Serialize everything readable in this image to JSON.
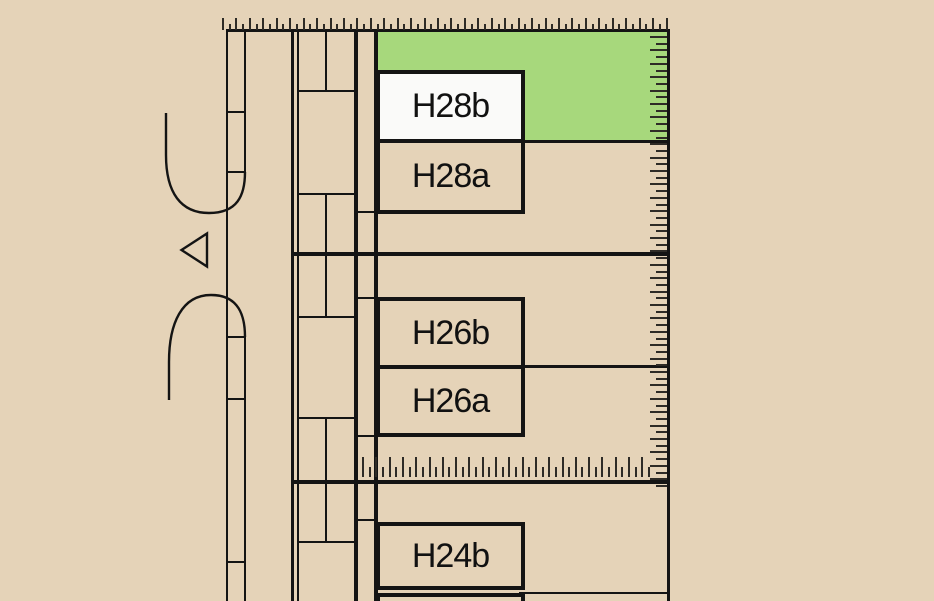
{
  "labels": {
    "h28b": "H28b",
    "h28a": "H28a",
    "h26b": "H26b",
    "h26a": "H26a",
    "h24b": "H24b"
  },
  "highlight": {
    "highlighted_area_plot": "H28b",
    "color": "#a7d87c"
  },
  "colors": {
    "background": "#e5d3b8",
    "line": "#141414",
    "tick": "#2e2b26",
    "selected_plot_fill": "#fafaf9",
    "highlight_green": "#a7d87c"
  },
  "rulers": {
    "top": {
      "orientation": "horizontal",
      "x": 222,
      "base_y": 30,
      "step": 6.72,
      "count": 67,
      "long_px": 12,
      "short_px": 6,
      "thickness": 2
    },
    "right": {
      "orientation": "vertical",
      "y": 36,
      "base_x": 667,
      "step": 6.7,
      "count": 68,
      "long_px": 17,
      "short_px": 11,
      "thickness": 2
    },
    "middle": {
      "orientation": "horizontal",
      "x": 362,
      "base_y": 477,
      "step": 6.65,
      "count": 44,
      "long_px": 20,
      "short_px": 10,
      "thickness": 2
    }
  }
}
